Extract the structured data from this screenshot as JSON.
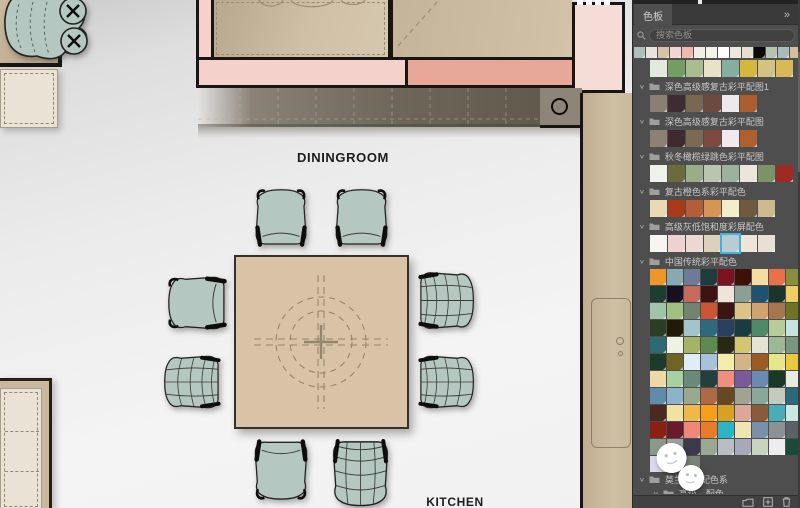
{
  "floorplan": {
    "labels": {
      "dining": "DININGROOM",
      "kitchen": "KITCHEN"
    },
    "colors": {
      "floor": "#efefef",
      "wall": "#181512",
      "room_tan": "#cfc0a6",
      "table_top": "#d8c3a6",
      "chair_fill": "#b4c7c1",
      "band_light_pink": "#f4d2cb",
      "band_salmon": "#e7a89a",
      "corner_room_pink": "#f6dcd7",
      "counter_dark": "#5e5648",
      "kitchen_strip": "#cfbfa3",
      "rug_cream": "#eae3d5"
    },
    "dining_chairs": 8
  },
  "panel": {
    "tab": "色板",
    "collapse_icon": "»",
    "search_placeholder": "搜索色板",
    "recent_colors": [
      "#aebfbc",
      "#e8e4dc",
      "#d6c3a5",
      "#f0d5d2",
      "#edb8b0",
      "#f2ede4",
      "#f5f2ec",
      "#ffffff",
      "#ece8df",
      "#e5dfd2",
      "#0a0a0a",
      "#b5c4b0",
      "#a8bcc0",
      "#d2bfa0"
    ],
    "selection_border_color": "#41b2e0",
    "sections": [
      {
        "type": "swatch-row",
        "colors": [
          "#e4e9df",
          "#739e63",
          "#a9bd8c",
          "#e9e2c6",
          "#86ae9e",
          "#d4b83e",
          "#d0c383",
          "#d7ba57"
        ]
      },
      {
        "type": "group-header",
        "label": "深色高级感复古彩平配图1"
      },
      {
        "type": "swatch-row",
        "colors": [
          "#8a7f72",
          "#3f2b33",
          "#77684f",
          "#6e4a3e",
          "#eee8ee",
          "#ad5e2e"
        ]
      },
      {
        "type": "group-header",
        "label": "深色高级感复古彩平配图"
      },
      {
        "type": "swatch-row",
        "colors": [
          "#8d8175",
          "#402a30",
          "#7b6a52",
          "#7e4a3f",
          "#f0eaf0",
          "#b0602f"
        ]
      },
      {
        "type": "group-header",
        "label": "秋冬橄榄绿跳色彩平配图"
      },
      {
        "type": "swatch-row",
        "colors": [
          "#eff1ec",
          "#6b6b3d",
          "#9aad89",
          "#b9c5af",
          "#9cb29c",
          "#ece6da",
          "#7c9367",
          "#9e2a24"
        ]
      },
      {
        "type": "group-header",
        "label": "复古橙色系彩平配色"
      },
      {
        "type": "swatch-row",
        "colors": [
          "#e9dab1",
          "#a83a18",
          "#b55c38",
          "#d89455",
          "#f3edc9",
          "#6e5a3e",
          "#ccb98f"
        ]
      },
      {
        "type": "group-header",
        "label": "高级灰低饱和度彩屏配色"
      },
      {
        "type": "swatch-row",
        "selected": 4,
        "colors": [
          "#f7f5f2",
          "#eed2cf",
          "#ecd8d0",
          "#ddd0bd",
          "#b8ccd1",
          "#ece5d8",
          "#e8e0d4"
        ]
      },
      {
        "type": "group-header",
        "label": "中国传统彩平配色"
      },
      {
        "type": "swatch-grid",
        "rows": [
          [
            "#ef9629",
            "#87aab2",
            "#6f7a96",
            "#203c3a",
            "#7c1220",
            "#3c1208",
            "#f2dfa0",
            "#e8714a",
            "#8a8c3e"
          ],
          [
            "#1d3d32",
            "#17111f",
            "#c76a5e",
            "#3d1313",
            "#f0e4da",
            "#8ba095",
            "#1d5270",
            "#1c352a",
            "#ecce62"
          ],
          [
            "#9fc4a8",
            "#a3c083",
            "#72836f",
            "#cf5434",
            "#3b150f",
            "#dcc387",
            "#d2a170",
            "#a5764f",
            "#6d7520"
          ],
          [
            "#2c3d26",
            "#201a07",
            "#a3c4cc",
            "#2d6a80",
            "#2a3f5e",
            "#173c43",
            "#4d8a6a",
            "#b8cc9a",
            "#c8e4e0"
          ],
          [
            "#2d6a72",
            "#eef2e0",
            "#a3b565",
            "#5d8a4d",
            "#2a2812",
            "#d4c670",
            "#e4e4d4",
            "#9eb896",
            "#7a9680"
          ],
          [
            "#1d3b2a",
            "#6d6426",
            "#dfedf7",
            "#a8c2dc",
            "#f4ecab",
            "#d2b586",
            "#9e5a24",
            "#e4e88a",
            "#e8c83c"
          ],
          [
            "#ecd9a4",
            "#a6d1a0",
            "#6a8a78",
            "#24403d",
            "#f08f80",
            "#7a5a9c",
            "#6a8ab3",
            "#1a3826",
            "#e6ece0"
          ],
          [
            "#5f8cab",
            "#8cb2cc",
            "#9aa88e",
            "#ae6a46",
            "#684824",
            "#a2a290",
            "#8aa89a",
            "#c4cabe",
            "#2a6a7a"
          ],
          [
            "#4a2a1e",
            "#f2e2a2",
            "#f0b84a",
            "#f5a018",
            "#d9a026",
            "#d9a898",
            "#8a5a3a",
            "#4aacb8",
            "#c8e8e4"
          ],
          [
            "#8a1f14",
            "#6a1a2a",
            "#f0887a",
            "#e87c28",
            "#2ab4c4",
            "#f0e4b0",
            "#7a90a8",
            "#8a9296",
            "#5a6268"
          ],
          [
            "#8a9a8a",
            "#9aa0a0",
            "#3a3a4a",
            "#9aa895",
            "#b8bec4",
            "#a8a8bc",
            "#c8d4c0",
            "#ededed",
            "#1a4a3a"
          ],
          [
            "#d8d8e8",
            "#8a7468",
            "#7a8474"
          ]
        ]
      },
      {
        "type": "group-header",
        "label": "莫兰迪…配色系"
      },
      {
        "type": "group-header",
        "label": "高级…配色",
        "indent": 1
      },
      {
        "type": "swatch-row",
        "size": "wide",
        "colors": [
          "#e9edf2",
          "#e2e9ea",
          "#d3dfe5",
          "#d9dad3",
          "#e9e9e1",
          "#f0f1e9",
          "#f1edd2"
        ]
      }
    ]
  }
}
